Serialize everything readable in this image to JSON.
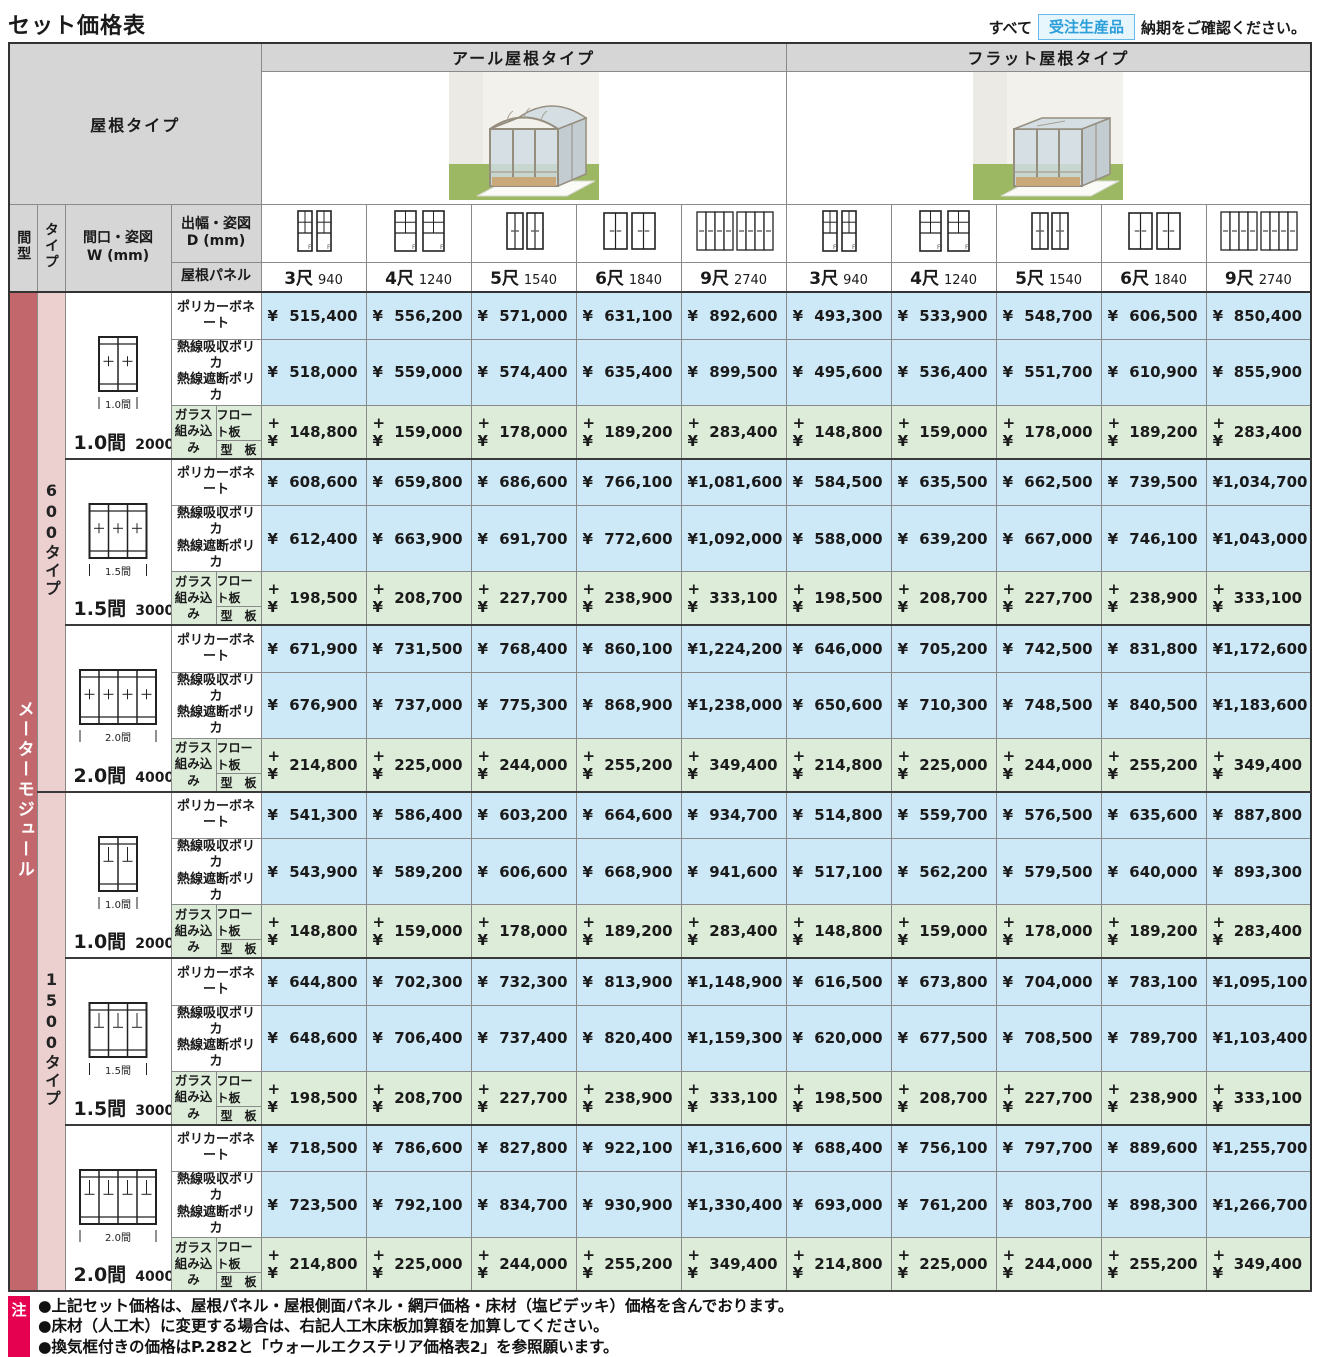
{
  "page": {
    "title": "セット価格表",
    "order_note": {
      "prefix": "すべて",
      "badge": "受注生産品",
      "suffix": "納期をご確認ください。"
    }
  },
  "table": {
    "roof_type_label": "屋根タイプ",
    "groups": [
      {
        "label": "アール屋根タイプ",
        "roof": "arch"
      },
      {
        "label": "フラット屋根タイプ",
        "roof": "flat"
      }
    ],
    "corner": {
      "madori": "間型",
      "type": "タイプ",
      "width": "間口・姿図\nW (mm)",
      "depth": "出幅・姿図\nD (mm)",
      "roof_panel": "屋根パネル"
    },
    "sizes": [
      {
        "shaku": "3尺",
        "mm": "940",
        "icon": "dh-narrow"
      },
      {
        "shaku": "4尺",
        "mm": "1240",
        "icon": "dh-wide"
      },
      {
        "shaku": "5尺",
        "mm": "1540",
        "icon": "slider"
      },
      {
        "shaku": "6尺",
        "mm": "1840",
        "icon": "slider-wide"
      },
      {
        "shaku": "9尺",
        "mm": "2740",
        "icon": "multi"
      }
    ],
    "madori_label": "メーターモジュール",
    "row_labels": {
      "poly": "ポリカーボネート",
      "heat": "熱線吸収ポリカ\n熱線遮断ポリカ",
      "glass": "ガラス\n組み込み",
      "glass_sub": [
        "フロート板",
        "型　板"
      ]
    },
    "colors": {
      "price_blue": "#cde8f6",
      "price_green": "#dcecd9",
      "header_gray": "#d6d6d6",
      "madori_red": "#c2686c",
      "type_pink": "#ecd0d0",
      "note_red": "#e60050",
      "badge_blue": "#2b9fd9"
    },
    "sections": [
      {
        "type_label": "600タイプ",
        "variant": "600",
        "blocks": [
          {
            "width_label": "1.0間",
            "width_mm": "2000",
            "panels": 2,
            "rows": [
              {
                "kind": "poly",
                "prefix": "¥",
                "arch": [
                  "515,400",
                  "556,200",
                  "571,000",
                  "631,100",
                  "892,600"
                ],
                "flat": [
                  "493,300",
                  "533,900",
                  "548,700",
                  "606,500",
                  "850,400"
                ]
              },
              {
                "kind": "heat",
                "prefix": "¥",
                "arch": [
                  "518,000",
                  "559,000",
                  "574,400",
                  "635,400",
                  "899,500"
                ],
                "flat": [
                  "495,600",
                  "536,400",
                  "551,700",
                  "610,900",
                  "855,900"
                ]
              },
              {
                "kind": "glass",
                "prefix": "+¥",
                "arch": [
                  "148,800",
                  "159,000",
                  "178,000",
                  "189,200",
                  "283,400"
                ],
                "flat": [
                  "148,800",
                  "159,000",
                  "178,000",
                  "189,200",
                  "283,400"
                ]
              }
            ]
          },
          {
            "width_label": "1.5間",
            "width_mm": "3000",
            "panels": 3,
            "rows": [
              {
                "kind": "poly",
                "prefix": "¥",
                "arch": [
                  "608,600",
                  "659,800",
                  "686,600",
                  "766,100",
                  "1,081,600"
                ],
                "flat": [
                  "584,500",
                  "635,500",
                  "662,500",
                  "739,500",
                  "1,034,700"
                ]
              },
              {
                "kind": "heat",
                "prefix": "¥",
                "arch": [
                  "612,400",
                  "663,900",
                  "691,700",
                  "772,600",
                  "1,092,000"
                ],
                "flat": [
                  "588,000",
                  "639,200",
                  "667,000",
                  "746,100",
                  "1,043,000"
                ]
              },
              {
                "kind": "glass",
                "prefix": "+¥",
                "arch": [
                  "198,500",
                  "208,700",
                  "227,700",
                  "238,900",
                  "333,100"
                ],
                "flat": [
                  "198,500",
                  "208,700",
                  "227,700",
                  "238,900",
                  "333,100"
                ]
              }
            ]
          },
          {
            "width_label": "2.0間",
            "width_mm": "4000",
            "panels": 4,
            "rows": [
              {
                "kind": "poly",
                "prefix": "¥",
                "arch": [
                  "671,900",
                  "731,500",
                  "768,400",
                  "860,100",
                  "1,224,200"
                ],
                "flat": [
                  "646,000",
                  "705,200",
                  "742,500",
                  "831,800",
                  "1,172,600"
                ]
              },
              {
                "kind": "heat",
                "prefix": "¥",
                "arch": [
                  "676,900",
                  "737,000",
                  "775,300",
                  "868,900",
                  "1,238,000"
                ],
                "flat": [
                  "650,600",
                  "710,300",
                  "748,500",
                  "840,500",
                  "1,183,600"
                ]
              },
              {
                "kind": "glass",
                "prefix": "+¥",
                "arch": [
                  "214,800",
                  "225,000",
                  "244,000",
                  "255,200",
                  "349,400"
                ],
                "flat": [
                  "214,800",
                  "225,000",
                  "244,000",
                  "255,200",
                  "349,400"
                ]
              }
            ]
          }
        ]
      },
      {
        "type_label": "1500タイプ",
        "variant": "1500",
        "blocks": [
          {
            "width_label": "1.0間",
            "width_mm": "2000",
            "panels": 2,
            "rows": [
              {
                "kind": "poly",
                "prefix": "¥",
                "arch": [
                  "541,300",
                  "586,400",
                  "603,200",
                  "664,600",
                  "934,700"
                ],
                "flat": [
                  "514,800",
                  "559,700",
                  "576,500",
                  "635,600",
                  "887,800"
                ]
              },
              {
                "kind": "heat",
                "prefix": "¥",
                "arch": [
                  "543,900",
                  "589,200",
                  "606,600",
                  "668,900",
                  "941,600"
                ],
                "flat": [
                  "517,100",
                  "562,200",
                  "579,500",
                  "640,000",
                  "893,300"
                ]
              },
              {
                "kind": "glass",
                "prefix": "+¥",
                "arch": [
                  "148,800",
                  "159,000",
                  "178,000",
                  "189,200",
                  "283,400"
                ],
                "flat": [
                  "148,800",
                  "159,000",
                  "178,000",
                  "189,200",
                  "283,400"
                ]
              }
            ]
          },
          {
            "width_label": "1.5間",
            "width_mm": "3000",
            "panels": 3,
            "rows": [
              {
                "kind": "poly",
                "prefix": "¥",
                "arch": [
                  "644,800",
                  "702,300",
                  "732,300",
                  "813,900",
                  "1,148,900"
                ],
                "flat": [
                  "616,500",
                  "673,800",
                  "704,000",
                  "783,100",
                  "1,095,100"
                ]
              },
              {
                "kind": "heat",
                "prefix": "¥",
                "arch": [
                  "648,600",
                  "706,400",
                  "737,400",
                  "820,400",
                  "1,159,300"
                ],
                "flat": [
                  "620,000",
                  "677,500",
                  "708,500",
                  "789,700",
                  "1,103,400"
                ]
              },
              {
                "kind": "glass",
                "prefix": "+¥",
                "arch": [
                  "198,500",
                  "208,700",
                  "227,700",
                  "238,900",
                  "333,100"
                ],
                "flat": [
                  "198,500",
                  "208,700",
                  "227,700",
                  "238,900",
                  "333,100"
                ]
              }
            ]
          },
          {
            "width_label": "2.0間",
            "width_mm": "4000",
            "panels": 4,
            "rows": [
              {
                "kind": "poly",
                "prefix": "¥",
                "arch": [
                  "718,500",
                  "786,600",
                  "827,800",
                  "922,100",
                  "1,316,600"
                ],
                "flat": [
                  "688,400",
                  "756,100",
                  "797,700",
                  "889,600",
                  "1,255,700"
                ]
              },
              {
                "kind": "heat",
                "prefix": "¥",
                "arch": [
                  "723,500",
                  "792,100",
                  "834,700",
                  "930,900",
                  "1,330,400"
                ],
                "flat": [
                  "693,000",
                  "761,200",
                  "803,700",
                  "898,300",
                  "1,266,700"
                ]
              },
              {
                "kind": "glass",
                "prefix": "+¥",
                "arch": [
                  "214,800",
                  "225,000",
                  "244,000",
                  "255,200",
                  "349,400"
                ],
                "flat": [
                  "214,800",
                  "225,000",
                  "244,000",
                  "255,200",
                  "349,400"
                ]
              }
            ]
          }
        ]
      }
    ]
  },
  "notes": {
    "badge": "注",
    "items": [
      "●上記セット価格は、屋根パネル・屋根側面パネル・網戸価格・床材（塩ビデッキ）価格を含んでおります。",
      "●床材（人工木）に変更する場合は、右記人工木床板加算額を加算してください。",
      "●換気框付きの価格はP.282と「ウォールエクステリア価格表2」を参照願います。"
    ]
  }
}
